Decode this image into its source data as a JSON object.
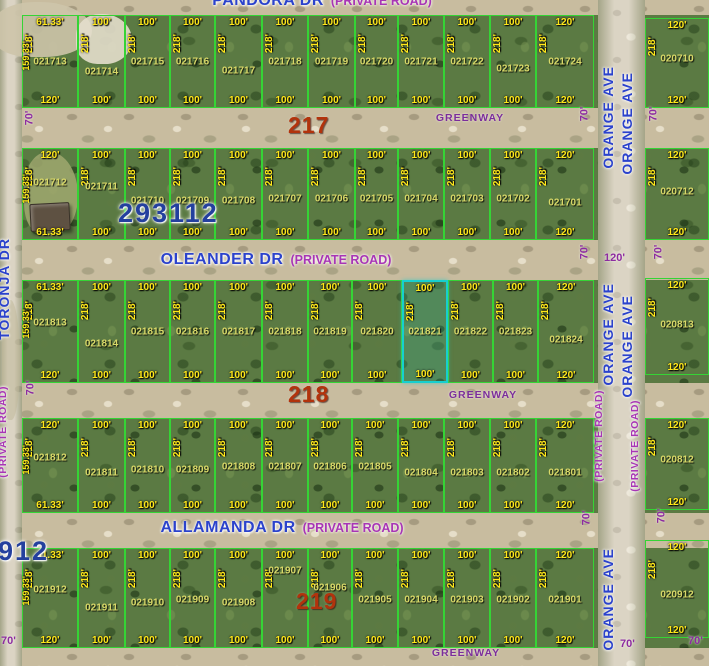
{
  "map": {
    "defaults": {
      "front": "100'",
      "depth": "218'"
    },
    "highlight_color": "#17cfcf",
    "parcel_line_color": "#35d435",
    "roads": [
      {
        "name": "pandora-dr",
        "x": 0,
        "y": 0,
        "w": 709,
        "h": 15
      },
      {
        "name": "greenway-north",
        "x": 0,
        "y": 108,
        "w": 709,
        "h": 40
      },
      {
        "name": "oleander-dr",
        "x": 0,
        "y": 240,
        "w": 709,
        "h": 40
      },
      {
        "name": "greenway-mid",
        "x": 0,
        "y": 383,
        "w": 709,
        "h": 35
      },
      {
        "name": "allamanda-dr",
        "x": 0,
        "y": 513,
        "w": 709,
        "h": 35
      },
      {
        "name": "greenway-south",
        "x": 0,
        "y": 648,
        "w": 709,
        "h": 18
      },
      {
        "name": "toronja-dr",
        "x": 0,
        "y": 0,
        "w": 22,
        "h": 666,
        "v": 1
      },
      {
        "name": "orange-ave",
        "x": 598,
        "y": 0,
        "w": 47,
        "h": 666,
        "v": 1
      }
    ],
    "terrain_patches": [
      {
        "x": -8,
        "y": 2,
        "w": 100,
        "h": 55,
        "c": "rgba(205,196,170,0.9)"
      },
      {
        "x": 76,
        "y": 14,
        "w": 56,
        "h": 50,
        "c": "rgba(228,222,204,0.9)"
      },
      {
        "x": 24,
        "y": 152,
        "w": 54,
        "h": 84,
        "c": "rgba(160,168,110,0.85)"
      },
      {
        "x": 2,
        "y": 300,
        "w": 18,
        "h": 120,
        "c": "rgba(190,182,150,0.5)"
      }
    ],
    "house": {
      "x": 30,
      "y": 203,
      "w": 38,
      "h": 26
    },
    "rows": [
      {
        "y": 15,
        "h": 93,
        "parcels": [
          {
            "id": "021713",
            "x": 22,
            "w": 56,
            "top": "61.33'",
            "bot": "120'",
            "left": "159.33'"
          },
          {
            "id": "021714",
            "x": 78,
            "w": 47,
            "ly": 0.62
          },
          {
            "id": "021715",
            "x": 125,
            "w": 45
          },
          {
            "id": "021716",
            "x": 170,
            "w": 45
          },
          {
            "id": "021717",
            "x": 215,
            "w": 47,
            "ly": 0.6
          },
          {
            "id": "021718",
            "x": 262,
            "w": 46
          },
          {
            "id": "021719",
            "x": 308,
            "w": 47
          },
          {
            "id": "021720",
            "x": 355,
            "w": 43
          },
          {
            "id": "021721",
            "x": 398,
            "w": 46
          },
          {
            "id": "021722",
            "x": 444,
            "w": 46
          },
          {
            "id": "021723",
            "x": 490,
            "w": 46,
            "ly": 0.58
          },
          {
            "id": "021724",
            "x": 536,
            "w": 58,
            "top": "120'",
            "bot": "120'"
          }
        ]
      },
      {
        "y": 148,
        "h": 92,
        "parcels": [
          {
            "id": "021712",
            "x": 22,
            "w": 56,
            "top": "120'",
            "bot": "61.33'",
            "left": "159.33'",
            "ly": 0.38
          },
          {
            "id": "021711",
            "x": 78,
            "w": 47,
            "ly": 0.42
          },
          {
            "id": "021710",
            "x": 125,
            "w": 45,
            "ly": 0.58
          },
          {
            "id": "021709",
            "x": 170,
            "w": 45,
            "ly": 0.58
          },
          {
            "id": "021708",
            "x": 215,
            "w": 47,
            "ly": 0.58
          },
          {
            "id": "021707",
            "x": 262,
            "w": 46,
            "ly": 0.55
          },
          {
            "id": "021706",
            "x": 308,
            "w": 47,
            "ly": 0.55
          },
          {
            "id": "021705",
            "x": 355,
            "w": 43,
            "ly": 0.55
          },
          {
            "id": "021704",
            "x": 398,
            "w": 46,
            "ly": 0.55
          },
          {
            "id": "021703",
            "x": 444,
            "w": 46,
            "ly": 0.55
          },
          {
            "id": "021702",
            "x": 490,
            "w": 46,
            "ly": 0.55
          },
          {
            "id": "021701",
            "x": 536,
            "w": 58,
            "top": "120'",
            "bot": "120'",
            "ly": 0.6
          }
        ]
      },
      {
        "y": 280,
        "h": 103,
        "parcels": [
          {
            "id": "021813",
            "x": 22,
            "w": 56,
            "top": "61.33'",
            "bot": "120'",
            "left": "159.33'",
            "ly": 0.42
          },
          {
            "id": "021814",
            "x": 78,
            "w": 47,
            "ly": 0.62
          },
          {
            "id": "021815",
            "x": 125,
            "w": 45
          },
          {
            "id": "021816",
            "x": 170,
            "w": 45
          },
          {
            "id": "021817",
            "x": 215,
            "w": 47
          },
          {
            "id": "021818",
            "x": 262,
            "w": 46
          },
          {
            "id": "021819",
            "x": 308,
            "w": 44
          },
          {
            "id": "021820",
            "x": 352,
            "w": 50
          },
          {
            "id": "021821",
            "x": 402,
            "w": 46,
            "hl": true
          },
          {
            "id": "021822",
            "x": 448,
            "w": 45
          },
          {
            "id": "021823",
            "x": 493,
            "w": 45
          },
          {
            "id": "021824",
            "x": 538,
            "w": 56,
            "top": "120'",
            "bot": "120'",
            "ly": 0.58
          }
        ]
      },
      {
        "y": 418,
        "h": 95,
        "parcels": [
          {
            "id": "021812",
            "x": 22,
            "w": 56,
            "top": "120'",
            "bot": "61.33'",
            "left": "159.33'",
            "ly": 0.42
          },
          {
            "id": "021811",
            "x": 78,
            "w": 47,
            "ly": 0.58
          },
          {
            "id": "021810",
            "x": 125,
            "w": 45,
            "ly": 0.55
          },
          {
            "id": "021809",
            "x": 170,
            "w": 45,
            "ly": 0.55
          },
          {
            "id": "021808",
            "x": 215,
            "w": 47,
            "ly": 0.52
          },
          {
            "id": "021807",
            "x": 262,
            "w": 46,
            "ly": 0.52
          },
          {
            "id": "021806",
            "x": 308,
            "w": 44,
            "ly": 0.52
          },
          {
            "id": "021805",
            "x": 352,
            "w": 46,
            "ly": 0.52
          },
          {
            "id": "021804",
            "x": 398,
            "w": 46,
            "ly": 0.58
          },
          {
            "id": "021803",
            "x": 444,
            "w": 46,
            "ly": 0.58
          },
          {
            "id": "021802",
            "x": 490,
            "w": 46,
            "ly": 0.58
          },
          {
            "id": "021801",
            "x": 536,
            "w": 58,
            "top": "120'",
            "bot": "120'",
            "ly": 0.58
          }
        ]
      },
      {
        "y": 548,
        "h": 100,
        "parcels": [
          {
            "id": "021912",
            "x": 22,
            "w": 56,
            "top": "61.33'",
            "bot": "120'",
            "left": "159.33'",
            "ly": 0.42
          },
          {
            "id": "021911",
            "x": 78,
            "w": 47,
            "ly": 0.6
          },
          {
            "id": "021910",
            "x": 125,
            "w": 45,
            "ly": 0.55
          },
          {
            "id": "021909",
            "x": 170,
            "w": 45,
            "ly": 0.52
          },
          {
            "id": "021908",
            "x": 215,
            "w": 47,
            "ly": 0.55
          },
          {
            "id": "021907",
            "x": 262,
            "w": 46,
            "ly": 0.22
          },
          {
            "id": "021906",
            "x": 308,
            "w": 44,
            "ly": 0.4
          },
          {
            "id": "021905",
            "x": 352,
            "w": 46,
            "ly": 0.52
          },
          {
            "id": "021904",
            "x": 398,
            "w": 46,
            "ly": 0.52
          },
          {
            "id": "021903",
            "x": 444,
            "w": 46,
            "ly": 0.52
          },
          {
            "id": "021902",
            "x": 490,
            "w": 46,
            "ly": 0.52
          },
          {
            "id": "021901",
            "x": 536,
            "w": 58,
            "top": "120'",
            "bot": "120'",
            "ly": 0.52
          }
        ]
      }
    ],
    "right_column": {
      "x": 645,
      "w": 64,
      "parcels": [
        {
          "id": "020710",
          "y": 18,
          "h": 90,
          "top": "120'",
          "bot": "120'",
          "ly": 0.45
        },
        {
          "id": "020712",
          "y": 148,
          "h": 92,
          "top": "120'",
          "bot": "120'",
          "ly": 0.48
        },
        {
          "id": "020813",
          "y": 278,
          "h": 97,
          "top": "120'",
          "bot": "120'",
          "ly": 0.48
        },
        {
          "id": "020812",
          "y": 418,
          "h": 92,
          "top": "120'",
          "bot": "120'",
          "ly": 0.45
        },
        {
          "id": "020912",
          "y": 540,
          "h": 98,
          "top": "120'",
          "bot": "120'",
          "ly": 0.56
        }
      ]
    },
    "streets": {
      "horizontal": [
        {
          "label": "PANDORA DR",
          "suffix": "(PRIVATE ROAD)",
          "cx": 322,
          "cy": -8
        },
        {
          "label": "OLEANDER DR",
          "suffix": "(PRIVATE ROAD)",
          "cx": 276,
          "cy": 251
        },
        {
          "label": "ALLAMANDA DR",
          "suffix": "(PRIVATE ROAD)",
          "cx": 282,
          "cy": 519
        }
      ],
      "vertical": [
        {
          "label": "TORONJA DR",
          "x": -4,
          "y": 238
        },
        {
          "label": "(PRIVATE ROAD)",
          "x": -3,
          "y": 386,
          "purple": true
        },
        {
          "label": "ORANGE AVE",
          "x": 600,
          "y": 66
        },
        {
          "label": "ORANGE AVE",
          "x": 619,
          "y": 72
        },
        {
          "label": "ORANGE AVE",
          "x": 600,
          "y": 283
        },
        {
          "label": "ORANGE AVE",
          "x": 619,
          "y": 295
        },
        {
          "label": "ORANGE AVE",
          "x": 600,
          "y": 548
        },
        {
          "label": "(PRIVATE ROAD)",
          "x": 593,
          "y": 390,
          "purple": true
        },
        {
          "label": "(PRIVATE ROAD)",
          "x": 629,
          "y": 400,
          "purple": true
        }
      ]
    },
    "greenway_text": "GREENWAY",
    "greenways": [
      {
        "cx": 470,
        "cy": 112
      },
      {
        "cx": 483,
        "cy": 389
      },
      {
        "cx": 466,
        "cy": 647
      }
    ],
    "block_numbers": [
      {
        "text": "217",
        "x": 288,
        "y": 112
      },
      {
        "text": "218",
        "x": 288,
        "y": 381
      },
      {
        "text": "219",
        "x": 296,
        "y": 588
      }
    ],
    "plat_numbers": [
      {
        "text": "293112",
        "x": 118,
        "y": 198
      },
      {
        "text": "912",
        "x": -2,
        "y": 536
      }
    ],
    "road_width_labels": [
      {
        "text": "70'",
        "x": 22,
        "y": 112,
        "rot": true
      },
      {
        "text": "70'",
        "x": 23,
        "y": 382,
        "rot": true
      },
      {
        "text": "70'",
        "x": 1,
        "y": 635
      },
      {
        "text": "70'",
        "x": 577,
        "y": 108,
        "rot": true
      },
      {
        "text": "70'",
        "x": 646,
        "y": 108,
        "rot": true
      },
      {
        "text": "70'",
        "x": 577,
        "y": 246,
        "rot": true
      },
      {
        "text": "70'",
        "x": 651,
        "y": 246,
        "rot": true
      },
      {
        "text": "120'",
        "x": 604,
        "y": 252
      },
      {
        "text": "70'",
        "x": 579,
        "y": 512,
        "rot": true
      },
      {
        "text": "70'",
        "x": 654,
        "y": 510,
        "rot": true
      },
      {
        "text": "70'",
        "x": 620,
        "y": 638
      },
      {
        "text": "70'",
        "x": 688,
        "y": 635
      }
    ]
  }
}
